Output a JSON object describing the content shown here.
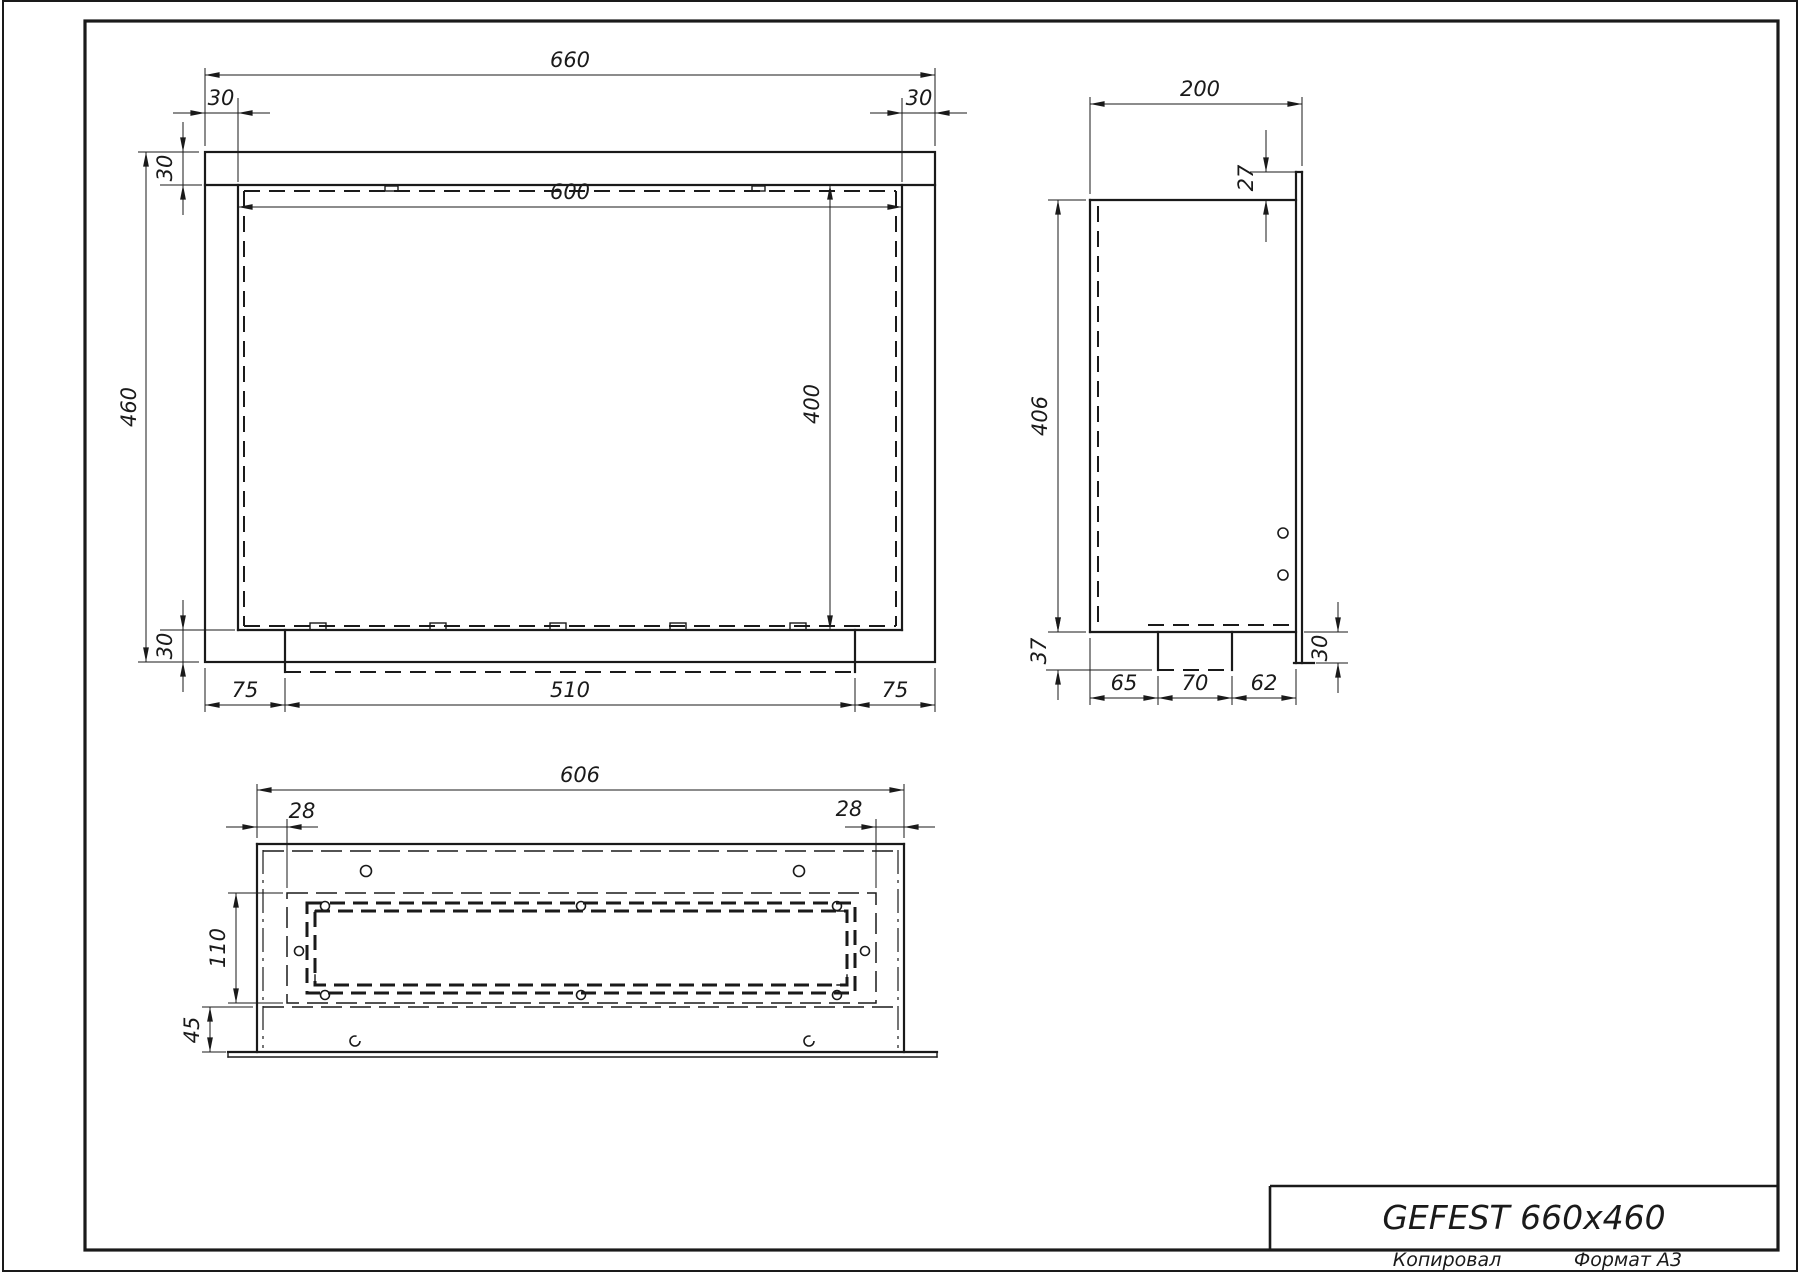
{
  "title_block": {
    "title": "GEFEST 660x460"
  },
  "footer": {
    "copied": "Копировал",
    "format": "Формат А3"
  },
  "front_view": {
    "dim_width": "660",
    "dim_side_left": "30",
    "dim_side_right": "30",
    "dim_top": "30",
    "dim_height": "460",
    "dim_bottom": "30",
    "dim_opening_width": "600",
    "dim_opening_height": "400",
    "dim_tray_left": "75",
    "dim_tray_width": "510",
    "dim_tray_right": "75"
  },
  "side_view": {
    "dim_depth": "200",
    "dim_lip": "27",
    "dim_height": "406",
    "dim_tray_drop": "37",
    "dim_seg_left": "65",
    "dim_seg_center": "70",
    "dim_seg_right": "62",
    "dim_flange_drop": "30"
  },
  "bottom_view": {
    "dim_width": "606",
    "dim_inset_left": "28",
    "dim_inset_right": "28",
    "dim_opening_depth": "110",
    "dim_front_offset": "45"
  }
}
